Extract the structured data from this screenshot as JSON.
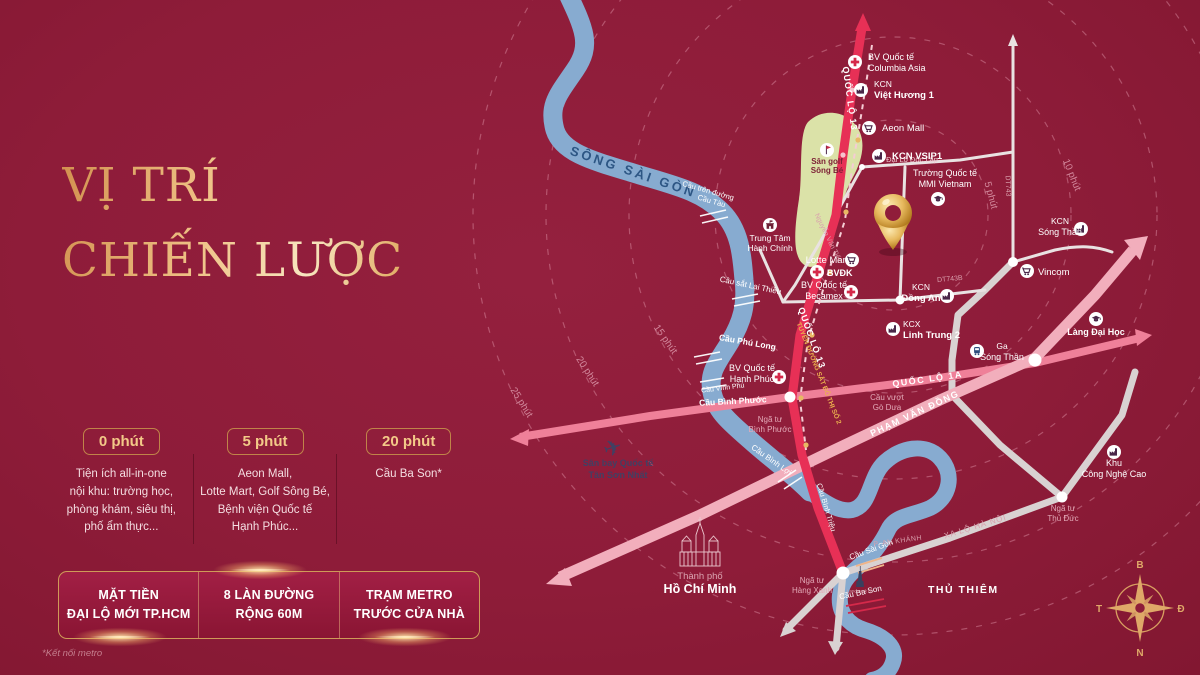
{
  "panel": {
    "title_l1": "VỊ TRÍ",
    "title_l2": "CHIẾN LƯỢC",
    "stats": [
      {
        "badge": "0 phút",
        "lines": [
          "Tiện ích all-in-one",
          "nội khu: trường học,",
          "phòng khám, siêu thị,",
          "phố ẩm thực..."
        ]
      },
      {
        "badge": "5 phút",
        "lines": [
          "Aeon Mall,",
          "Lotte Mart, Golf Sông Bé,",
          "Bệnh viện Quốc tế",
          "Hạnh Phúc..."
        ]
      },
      {
        "badge": "20 phút",
        "lines": [
          "Cầu Ba Son*"
        ]
      }
    ],
    "ribbon": [
      {
        "l1": "MẶT TIỀN",
        "l2": "ĐẠI LỘ MỚI TP.HCM"
      },
      {
        "l1": "8 LÀN ĐƯỜNG",
        "l2": "RỘNG 60M"
      },
      {
        "l1": "TRẠM METRO",
        "l2": "TRƯỚC CỬA NHÀ"
      }
    ],
    "footnote": "*Kết nối metro"
  },
  "map": {
    "river_label": "SÔNG SÀI GÒN",
    "rings": [
      "5 phút",
      "10 phút",
      "15 phút",
      "20 phút",
      "25 phút"
    ],
    "roads": {
      "ql13": "QUỐC LỘ 13",
      "metro": "TUYẾN ĐƯỜNG SẮT ĐÔ THỊ SỐ 2",
      "ql1a": "QUỐC LỘ 1A",
      "pvd": "PHẠM VĂN ĐỒNG",
      "xlhn": "XA LỘ HÀ NỘI",
      "doclap": "Đại Lộ Độc Lập",
      "dt743": "DT743",
      "dt743b": "DT743B",
      "nvt": "Nguyễn Văn Tiết"
    },
    "pois": {
      "columbia": {
        "l1": "BV Quốc tế",
        "l2": "Columbia Asia"
      },
      "viethuong": {
        "l1": "KCN",
        "l2": "Việt Hương 1"
      },
      "aeon": {
        "l1": "Aeon Mall"
      },
      "vsip": {
        "l1": "KCN VSIP1"
      },
      "mmi": {
        "l1": "Trường Quốc tế",
        "l2": "MMI Vietnam"
      },
      "golf": {
        "l1": "Sân golf",
        "l2": "Sông Bé"
      },
      "tthc": {
        "l1": "Trung Tâm",
        "l2": "Hành Chính"
      },
      "lotte": {
        "l1": "Lotte Mart"
      },
      "bvdk": {
        "l1": "BVĐK"
      },
      "becamex": {
        "l1": "BV Quốc tế",
        "l2": "Becamex"
      },
      "hanhphuc": {
        "l1": "BV Quốc tế",
        "l2": "Hạnh Phúc"
      },
      "dongan": {
        "l1": "KCN",
        "l2": "Đồng An"
      },
      "linhtrung": {
        "l1": "KCX",
        "l2": "Linh Trung 2"
      },
      "gasongthan": {
        "l1": "Ga",
        "l2": "Sóng Thần"
      },
      "kcnsongthan": {
        "l1": "KCN",
        "l2": "Sóng Thần"
      },
      "vincom": {
        "l1": "Vincom"
      },
      "langdaihoc": {
        "l1": "Làng Đại Học"
      },
      "kcnc": {
        "l1": "Khu",
        "l2": "Công Nghệ Cao"
      },
      "airport": {
        "l1": "Sân bay Quốc tế",
        "l2": "Tân Sơn Nhất"
      },
      "city": {
        "l1": "Thành phố",
        "l2": "Hồ Chí Minh"
      },
      "thuthiem": {
        "l1": "THỦ THIÊM"
      },
      "ankhanh": {
        "l1": "P. AN KHÁNH"
      },
      "landmark": {
        "l1": "Landmark 81"
      }
    },
    "junctions": {
      "binhphuoc": {
        "l1": "Ngã tư",
        "l2": "Bình Phước"
      },
      "hangxanh": {
        "l1": "Ngã tư",
        "l2": "Hàng Xanh"
      },
      "thuduc": {
        "l1": "Ngã tư",
        "l2": "Thủ Đức"
      },
      "godua": {
        "l1": "Cầu vượt",
        "l2": "Gò Dưa"
      }
    },
    "bridges": {
      "cautau_l1": "Cầu trên đường",
      "cautau_l2": "Cầu Tàu",
      "laithieu": "Cầu sắt Lại Thiều",
      "phulong": "Cầu Phú Long",
      "vinhphu": "Cầu Vĩnh Phú",
      "binhphuoc": "Cầu Bình Phước",
      "binhloi": "Cầu Bình Lợi",
      "binhtrieu": "Cầu Bình Triệu",
      "saigon": "Cầu Sài Gòn",
      "bason": "Cầu Ba Son"
    },
    "compass": {
      "n": "B",
      "e": "Đ",
      "s": "N",
      "w": "T"
    },
    "icons": {
      "plane_glyph": "✈"
    },
    "colors": {
      "background": "#8e1c39",
      "gold": "#e9b469",
      "river": "#87abd0",
      "ql13_red": "#e73056",
      "ql1a_pink": "#ef8099",
      "pvd_pink": "#f2aebc",
      "road_gray": "#d9d2d2",
      "golf_green": "#dbe2a8",
      "metro_gold": "#eaaf4e"
    }
  }
}
